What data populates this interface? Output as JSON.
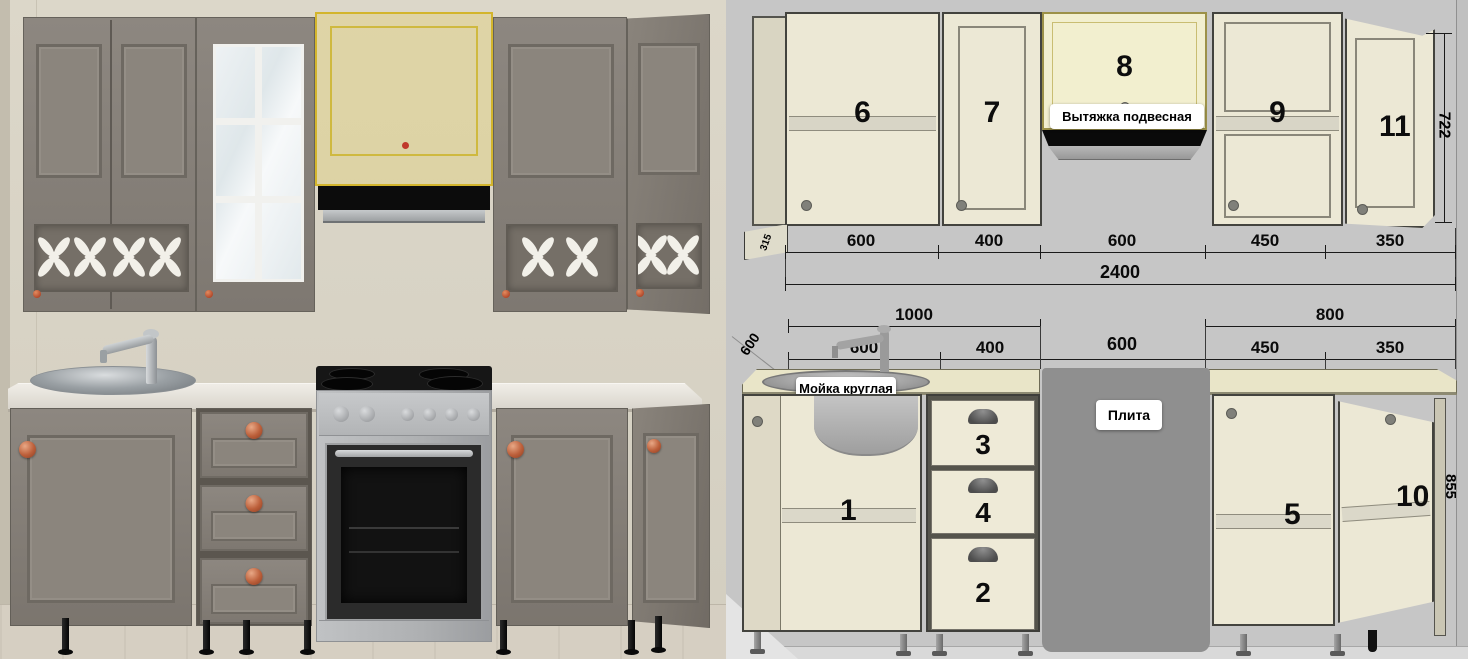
{
  "diagram": {
    "wall_numbers": [
      "6",
      "7",
      "8",
      "9",
      "11"
    ],
    "base_numbers": [
      "1",
      "3",
      "4",
      "2",
      "5",
      "10"
    ],
    "labels": {
      "hood": "Вытяжка подвесная",
      "sink": "Мойка круглая",
      "stove": "Плита"
    },
    "dims": {
      "upper_segments": [
        "600",
        "400",
        "600",
        "450",
        "350"
      ],
      "upper_total": "2400",
      "wall_depth": "315",
      "wall_height": "722",
      "group_left": "1000",
      "group_right": "800",
      "base_segments": [
        "600",
        "400",
        "600",
        "450",
        "350"
      ],
      "counter_depth": "600",
      "base_height": "855"
    }
  },
  "colors": {
    "selection_highlight": "#d3b52c",
    "diagram_background": "#c6c6c6",
    "cabinet_cream": "#ece8d5",
    "render_cabinet_taupe": "#87817a",
    "wall_beige": "#d8d3c5",
    "knob_copper": "#bc5f3a",
    "stove_gray": "#8f8f8f",
    "label_background": "#ffffff"
  }
}
